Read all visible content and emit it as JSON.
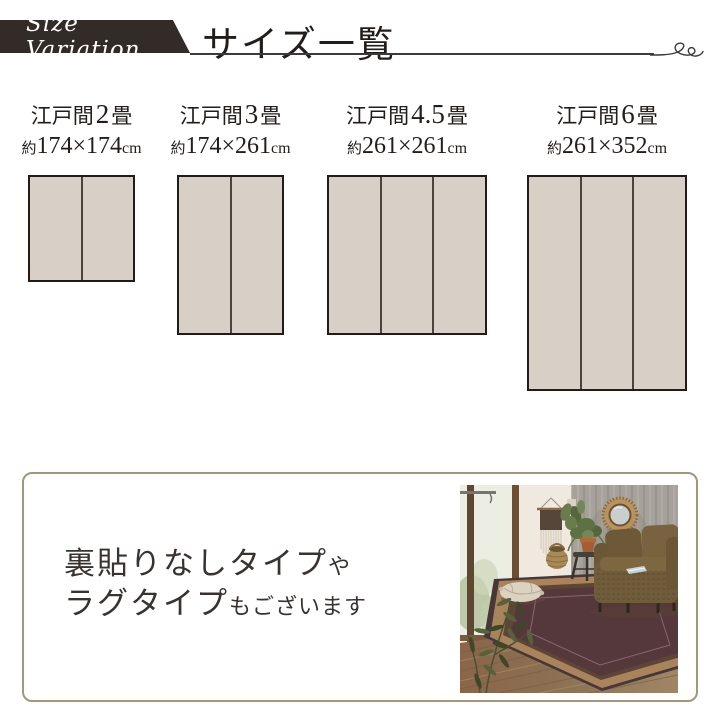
{
  "header": {
    "ribbon_label": "Size Variation",
    "title": "サイズ一覧"
  },
  "sizes": [
    {
      "name_prefix": "江戸間",
      "tatami_count": "2",
      "tatami_unit": "畳",
      "approx_prefix": "約",
      "dimensions": "174×174",
      "dimension_unit": "cm",
      "width_cm": 174,
      "height_cm": 174,
      "panel_count": 2
    },
    {
      "name_prefix": "江戸間",
      "tatami_count": "3",
      "tatami_unit": "畳",
      "approx_prefix": "約",
      "dimensions": "174×261",
      "dimension_unit": "cm",
      "width_cm": 174,
      "height_cm": 261,
      "panel_count": 2
    },
    {
      "name_prefix": "江戸間",
      "tatami_count": "4.5",
      "tatami_unit": "畳",
      "approx_prefix": "約",
      "dimensions": "261×261",
      "dimension_unit": "cm",
      "width_cm": 261,
      "height_cm": 261,
      "panel_count": 3
    },
    {
      "name_prefix": "江戸間",
      "tatami_count": "6",
      "tatami_unit": "畳",
      "approx_prefix": "約",
      "dimensions": "261×352",
      "dimension_unit": "cm",
      "width_cm": 261,
      "height_cm": 352,
      "panel_count": 3
    }
  ],
  "note_box": {
    "line1_main": "裏貼りなしタイプ",
    "line1_small": "や",
    "line2_main": "ラグタイプ",
    "line2_small": "もございます"
  },
  "photo": {
    "alt": "リビングルームに敷かれたボーダー柄ラグの写真"
  },
  "colors": {
    "ribbon_bg": "#332b27",
    "text": "#221d1a",
    "line": "#3b3b3b",
    "mat_fill": "#d8d0c6",
    "mat_border": "#211c18",
    "mat_divider": "#49443e",
    "box_border": "#a4967a"
  }
}
